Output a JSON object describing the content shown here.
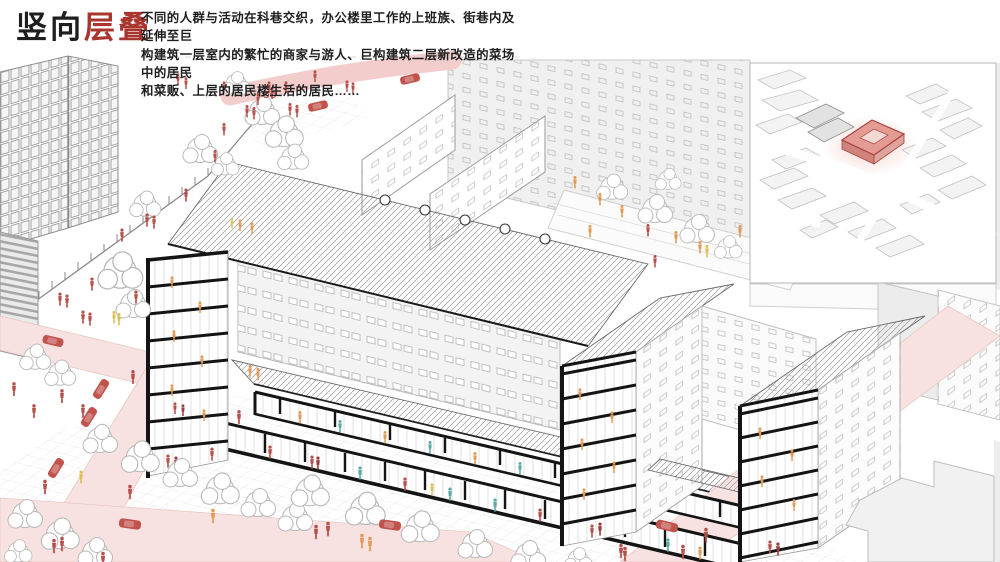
{
  "header": {
    "title_prefix": "竖向",
    "title_highlight": "层叠",
    "description_lines": [
      "不同的人群与活动在科巷交织，办公楼里工作的上班族、街巷内及延伸至巨",
      "构建筑一层室内的繁忙的商家与游人、巨构建筑二层新改造的菜场中的居民",
      "和菜贩、上层的居民楼生活的居民……"
    ]
  },
  "colors": {
    "ink": "#1e1e1e",
    "title-red": "#a8352e",
    "person-red": "#b5504b",
    "person-dark-red": "#9e3d3c",
    "person-orange": "#e09a55",
    "person-teal": "#5aaaa4",
    "person-yellow": "#ddbf55",
    "car-red": "#c1534d",
    "road-pink": "#f7e2e1",
    "road-pink-strong": "#f2cdcc",
    "section-black": "#141414",
    "line-gray": "#9a9a9a",
    "line-light": "#c7c7c7",
    "bg-building": "#f1f1f1",
    "site-highlight-fill": "#e39b94",
    "site-highlight-line": "#a8433c",
    "halo-pink": "#f3cdc7"
  }
}
